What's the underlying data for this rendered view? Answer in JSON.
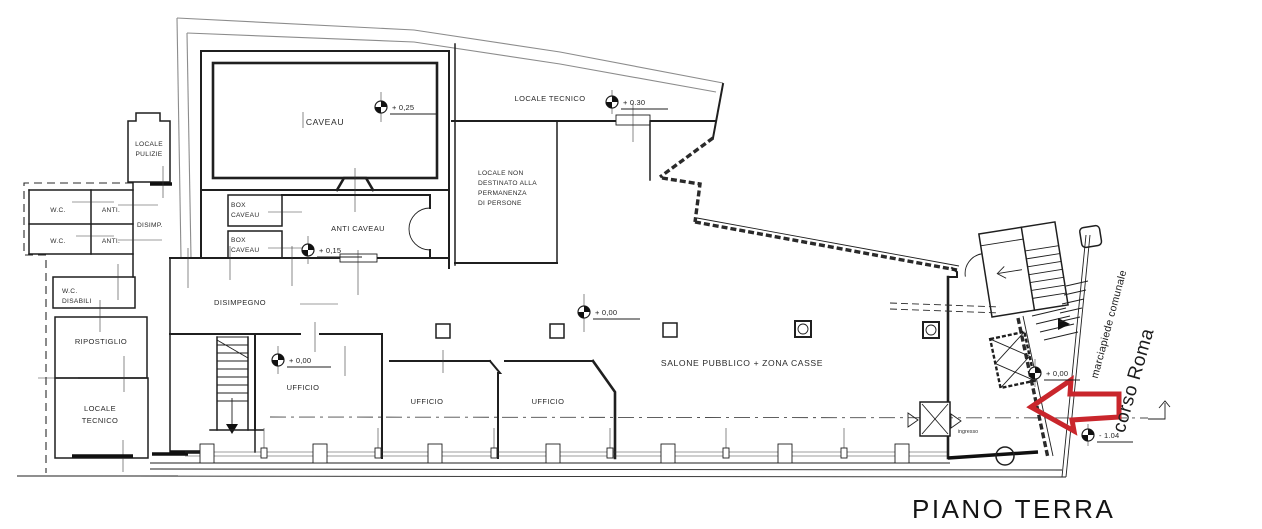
{
  "drawing": {
    "title": "PIANO TERRA",
    "colors": {
      "ink": "#1f1f1f",
      "muted_outline": "#8c8c8c",
      "accent_red": "#c9262c",
      "paper": "#ffffff"
    },
    "rooms": {
      "caveau": "CAVEAU",
      "box_caveau_top": [
        "BOX",
        "CAVEAU"
      ],
      "box_caveau_bottom": [
        "BOX",
        "CAVEAU"
      ],
      "anti_caveau": "ANTI CAVEAU",
      "locale_pulizie": [
        "LOCALE",
        "PULIZIE"
      ],
      "locale_tecnico_nord": "LOCALE TECNICO",
      "locale_non_destinato": [
        "LOCALE NON",
        "DESTINATO ALLA",
        "PERMANENZA",
        "DI PERSONE"
      ],
      "wc_top": "W.C.",
      "anti_top": "ANTI.",
      "wc_mid": "W.C.",
      "anti_mid": "ANTI.",
      "disimp": "DISIMP.",
      "wc_disabili": [
        "W.C.",
        "DISABILI"
      ],
      "ripostiglio": "RIPOSTIGLIO",
      "locale_tecnico_ovest": [
        "LOCALE",
        "TECNICO"
      ],
      "disimpegno": "DISIMPEGNO",
      "ufficio_1": "UFFICIO",
      "ufficio_2": "UFFICIO",
      "ufficio_3": "UFFICIO",
      "salone": "SALONE PUBBLICO + ZONA CASSE",
      "ingresso": "ingresso"
    },
    "elevations": {
      "caveau": "+ 0,25",
      "locale_tecnico": "+ 0.30",
      "anti_caveau": "+ 0,15",
      "ufficio": "+ 0,00",
      "salone": "+ 0,00",
      "vestibolo": "+ 0,00",
      "strada": "- 1.04"
    },
    "street": {
      "road": "corso Roma",
      "sidewalk": "marciapiede comunale"
    }
  }
}
